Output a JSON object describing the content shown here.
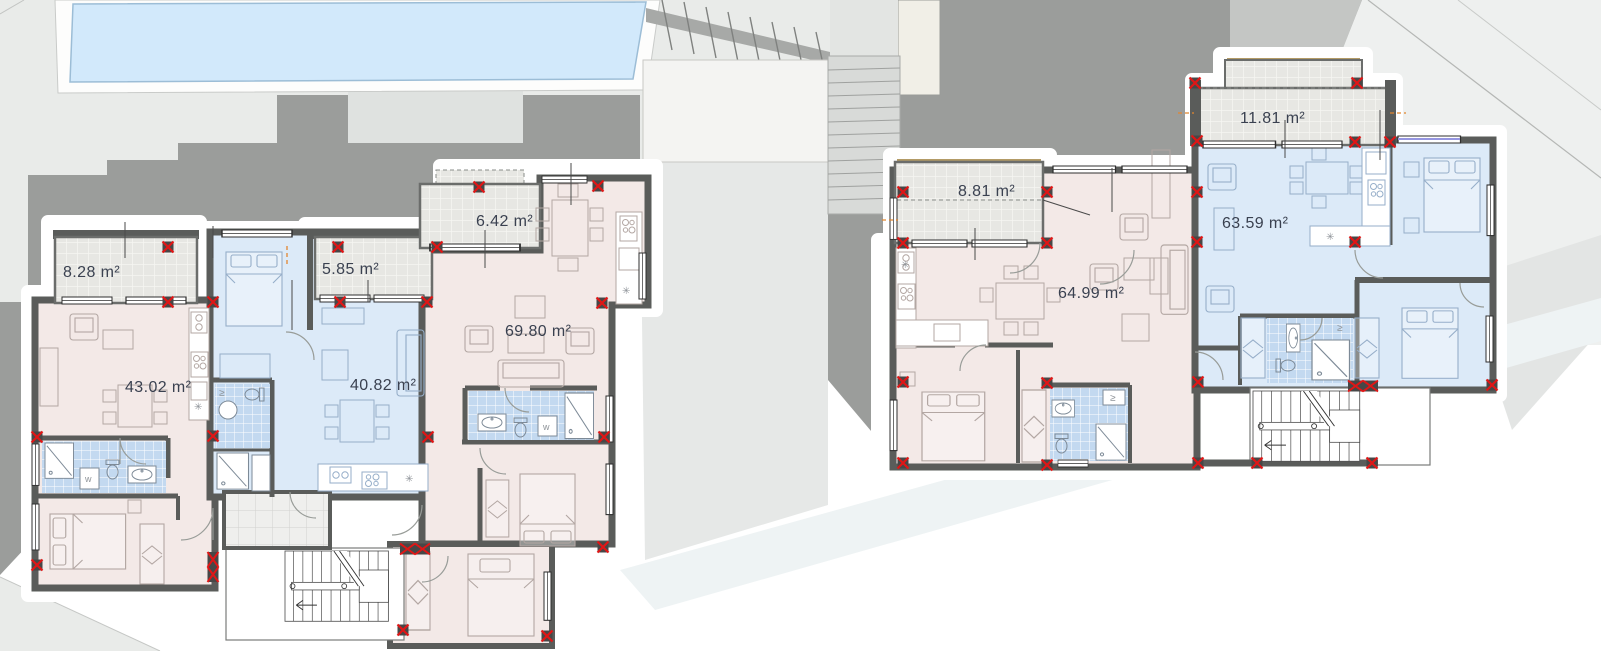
{
  "plan": {
    "buildings": [
      {
        "name": "left-building",
        "units": [
          {
            "name": "apartment",
            "area_label": "43.02 m²",
            "scheme": "pink"
          },
          {
            "name": "apartment",
            "area_label": "40.82 m²",
            "scheme": "blue"
          },
          {
            "name": "apartment",
            "area_label": "69.80 m²",
            "scheme": "pink"
          },
          {
            "name": "terrace",
            "area_label": "8.28 m²"
          },
          {
            "name": "terrace",
            "area_label": "5.85 m²"
          },
          {
            "name": "terrace",
            "area_label": "6.42 m²"
          }
        ]
      },
      {
        "name": "right-building",
        "units": [
          {
            "name": "apartment",
            "area_label": "64.99 m²",
            "scheme": "pink"
          },
          {
            "name": "apartment",
            "area_label": "63.59 m²",
            "scheme": "blue"
          },
          {
            "name": "terrace",
            "area_label": "8.81 m²"
          },
          {
            "name": "terrace",
            "area_label": "11.81 m²"
          }
        ]
      }
    ],
    "symbols": {
      "washer": "w",
      "vent": "✳",
      "rail": "≥"
    },
    "colors": {
      "apartment_pink": "#f3e9e7",
      "apartment_blue": "#dceaf8",
      "bath_tile": "#c3d9f0",
      "terrace": "#e8e8e4",
      "wall": "#5a5c5a",
      "column_marker": "#e01616",
      "pool_water": "#d2e9fb",
      "terrain_dark": "#9b9d9b",
      "terrain_light": "#e9ebe9",
      "label_text": "#3a4150"
    }
  }
}
